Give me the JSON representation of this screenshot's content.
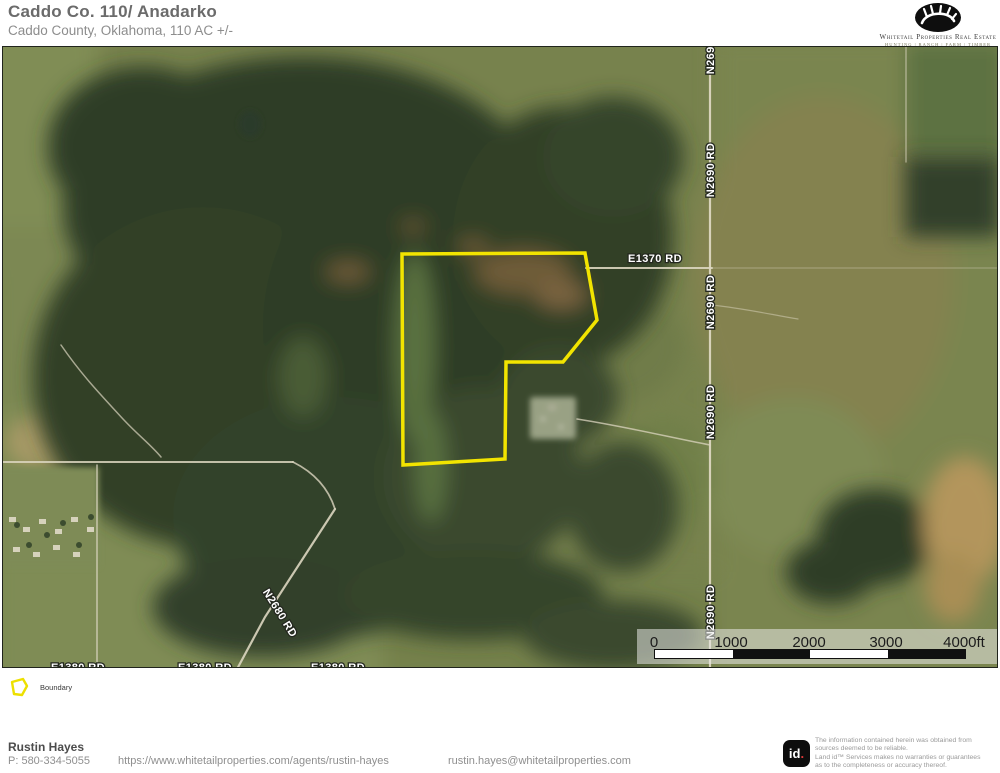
{
  "header": {
    "title": "Caddo Co. 110/ Anadarko",
    "subtitle": "Caddo County, Oklahoma, 110 AC +/-"
  },
  "brand": {
    "name": "Whitetail Properties Real Estate",
    "tagline": "HUNTING | RANCH | FARM | TIMBER"
  },
  "map": {
    "boundary_color": "#f2e400",
    "road_labels": {
      "e1370": "E1370 RD",
      "n2690": "N2690 RD",
      "n2680": "N2680 RD",
      "e1380": "E1380 RD"
    }
  },
  "scale_bar": {
    "labels": [
      "0",
      "1000",
      "2000",
      "3000",
      "4000ft"
    ]
  },
  "legend": {
    "boundary_label": "Boundary"
  },
  "footer": {
    "agent_name": "Rustin Hayes",
    "phone": "P: 580-334-5055",
    "website": "https://www.whitetailproperties.com/agents/rustin-hayes",
    "email": "rustin.hayes@whitetailproperties.com",
    "landid_text": "id",
    "landid_dot": ".",
    "disclaimer_lines": [
      "The information contained herein was obtained from",
      "sources deemed to be reliable.",
      "Land id™ Services makes no warranties or guarantees",
      "as to the completeness or accuracy thereof."
    ]
  }
}
